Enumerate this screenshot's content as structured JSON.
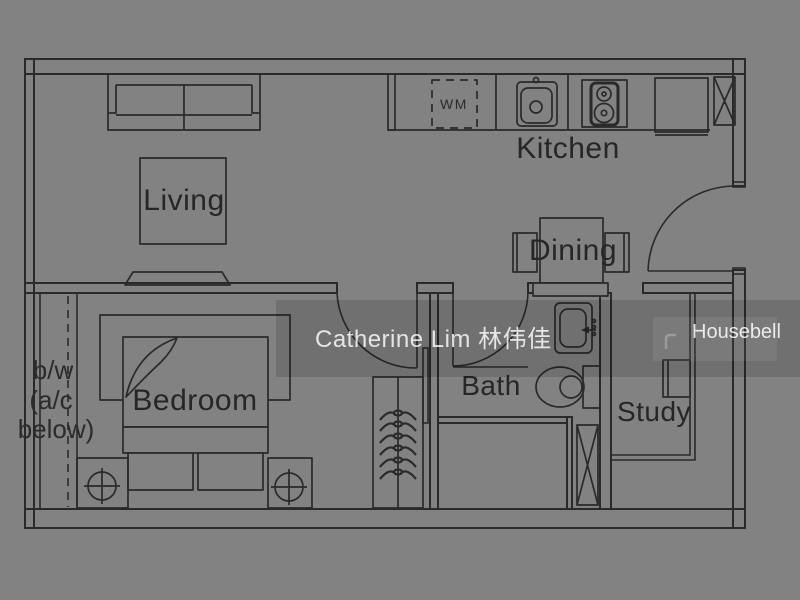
{
  "canvas": {
    "width": 800,
    "height": 600
  },
  "colors": {
    "background": "#828282",
    "plan_line": "#2a2a2a",
    "label_text": "#262626",
    "watermark_band": "rgba(0,0,0,0.135)",
    "watermark_text": "#ffffff"
  },
  "labels": {
    "living": "Living",
    "kitchen": "Kitchen",
    "dining": "Dining",
    "bedroom": "Bedroom",
    "bath": "Bath",
    "study": "Study"
  },
  "annotations": {
    "washing_machine": "WM",
    "bay_window": [
      "b/w",
      "(a/c",
      "below)"
    ]
  },
  "watermark": {
    "agent_name": "Catherine Lim 林伟佳",
    "brand": "Housebell"
  }
}
